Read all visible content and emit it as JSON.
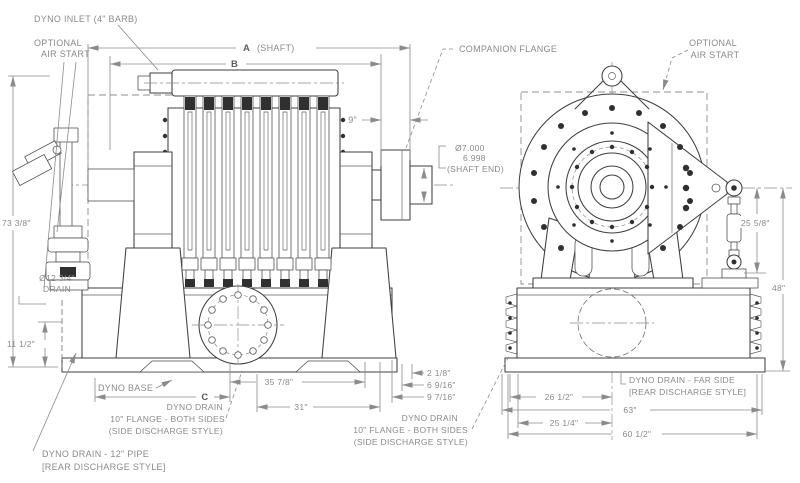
{
  "side_view": {
    "labels": {
      "inlet": "DYNO INLET (4\" BARB)",
      "air_start_1": "OPTIONAL",
      "air_start_2": "AIR START",
      "companion_flange": "COMPANION FLANGE",
      "shaft_end_dia_max": "Ø7.000",
      "shaft_end_dia_min": "6.998",
      "shaft_end_caption": "(SHAFT END)",
      "base": "DYNO BASE",
      "drain_dia": "Ø12 3/4\"",
      "drain_caption": "DRAIN",
      "side_drain_1": "DYNO DRAIN",
      "side_drain_2": "10\" FLANGE - BOTH SIDES",
      "side_drain_3": "(SIDE DISCHARGE STYLE)",
      "rear_drain_1": "DYNO DRAIN - 12\" PIPE",
      "rear_drain_2": "[REAR DISCHARGE STYLE]"
    },
    "dims": {
      "a": "A",
      "a_note": "(SHAFT)",
      "b": "B",
      "c": "C",
      "overall_height": "73 3/8\"",
      "foot_height": "11 1/2\"",
      "shaft_ext": "9\"",
      "len_35": "35 7/8\"",
      "len_31": "31\"",
      "off_2": "2 1/8\"",
      "off_6": "6 9/16\"",
      "off_9": "9 7/16\""
    }
  },
  "end_view": {
    "labels": {
      "air_start_1": "OPTIONAL",
      "air_start_2": "AIR START",
      "far_drain_1": "DYNO DRAIN - FAR SIDE",
      "far_drain_2": "[REAR DISCHARGE STYLE]"
    },
    "dims": {
      "link_height": "25 5/8\"",
      "cl_height": "48\"",
      "w_26": "26 1/2\"",
      "w_63": "63\"",
      "w_25": "25 1/4\"",
      "w_60": "60 1/2\""
    }
  },
  "colors": {
    "line": "#3f3f3f",
    "dim_gray": "#8b8b8b",
    "text_gray": "#8a8a8a",
    "dark_fill": "#303030",
    "background": "#ffffff"
  }
}
